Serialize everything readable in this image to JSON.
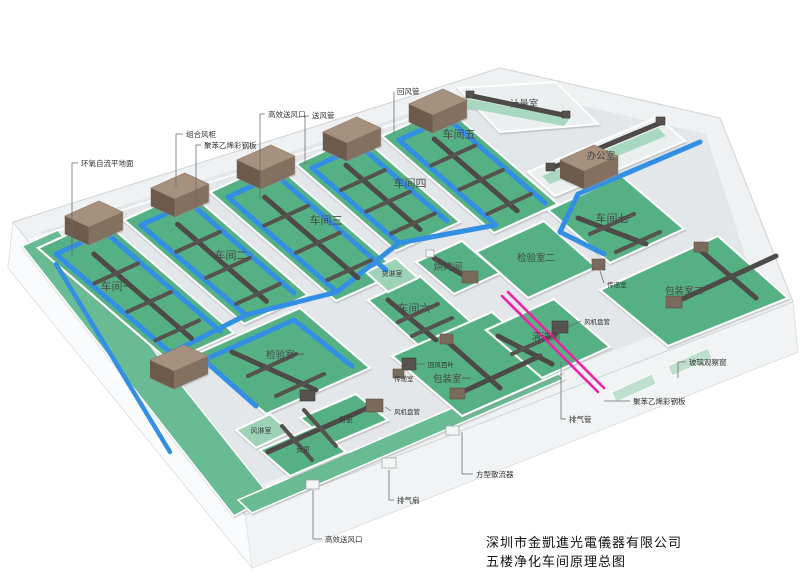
{
  "title": {
    "company": "深圳市金凱進光電儀器有限公司",
    "subtitle": "五楼净化车间原理总图"
  },
  "rooms": [
    {
      "label": "车间一"
    },
    {
      "label": "车间二"
    },
    {
      "label": "车间三"
    },
    {
      "label": "车间四"
    },
    {
      "label": "车间五"
    },
    {
      "label": "车间六"
    },
    {
      "label": "车间七"
    },
    {
      "label": "办公室"
    },
    {
      "label": "计量室"
    },
    {
      "label": "检验室一"
    },
    {
      "label": "检验室二"
    },
    {
      "label": "包装室一"
    },
    {
      "label": "包装室二"
    },
    {
      "label": "烘烤间"
    },
    {
      "label": "清洗间"
    },
    {
      "label": "货淋室"
    },
    {
      "label": "风淋室"
    },
    {
      "label": "传递室"
    },
    {
      "label": "男更"
    },
    {
      "label": "女更"
    }
  ],
  "annotations": [
    {
      "label": "环氧自流平地面"
    },
    {
      "label": "组合风柜"
    },
    {
      "label": "聚苯乙烯彩钢板"
    },
    {
      "label": "高效送风口"
    },
    {
      "label": "送风管"
    },
    {
      "label": "回风管"
    },
    {
      "label": "回风百叶"
    },
    {
      "label": "风机盘管"
    },
    {
      "label": "排气扇"
    },
    {
      "label": "排气管"
    },
    {
      "label": "方型散流器"
    },
    {
      "label": "玻璃观察窗"
    }
  ],
  "colors": {
    "floor_green": "#55b183",
    "corridor_green": "#67bb92",
    "pale_green": "#bfe0cf",
    "duct_blue": "#338fe3",
    "duct_dark": "#4d4a47",
    "ahu_brown": "#83705f",
    "exhaust_pink": "#ee22a6",
    "wall_white": "#fcfdfd",
    "slab_gray": "#eff1f2"
  }
}
